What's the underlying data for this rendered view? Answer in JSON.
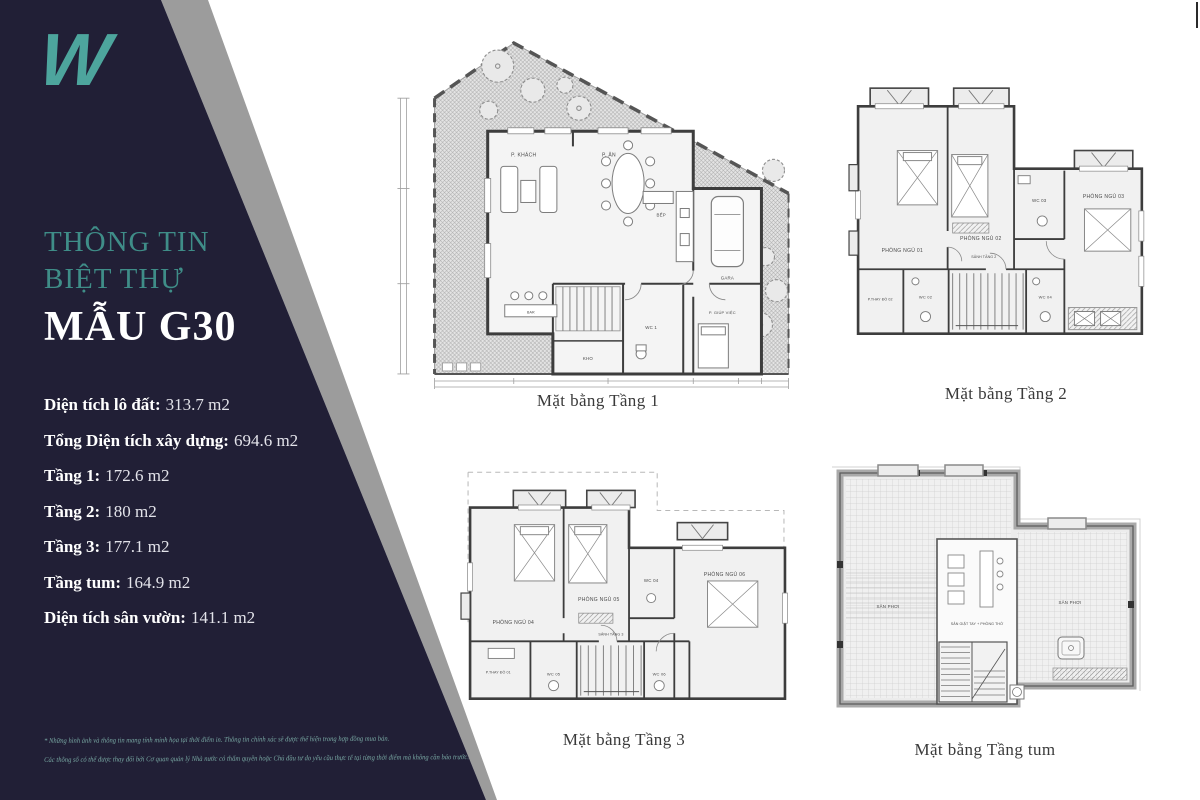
{
  "colors": {
    "navy": "#211f36",
    "gray_stripe": "#9c9c9c",
    "teal_logo": "#4da59d",
    "teal_heading": "#3f8d88",
    "disclaimer_teal": "#78a7a2",
    "caption_text": "#3a3a3a"
  },
  "sidebar": {
    "logo": "W",
    "title_line1": "THÔNG TIN",
    "title_line2": "BIỆT THỰ",
    "model": "MẪU G30",
    "stats": [
      {
        "label": "Diện tích lô đất:",
        "value": "313.7 m2"
      },
      {
        "label": "Tổng Diện tích xây dựng:",
        "value": "694.6 m2"
      },
      {
        "label": "Tầng 1:",
        "value": "172.6 m2"
      },
      {
        "label": "Tầng 2:",
        "value": "180 m2"
      },
      {
        "label": "Tầng 3:",
        "value": "177.1 m2"
      },
      {
        "label": "Tầng tum:",
        "value": "164.9 m2"
      },
      {
        "label": "Diện tích sân vườn:",
        "value": "141.1 m2"
      }
    ],
    "disclaimer_line1": "* Những hình ảnh và thông tin mang tính minh họa tại thời điểm in. Thông tin chính xác sẽ được thể hiện trong hợp đồng mua bán.",
    "disclaimer_line2": "Các thông số có thể được thay đổi bởi Cơ quan quản lý Nhà nước có thẩm quyền hoặc Chủ đầu tư do yêu cầu thực tế tại từng thời điểm mà không cần báo trước."
  },
  "plans": {
    "t1": {
      "caption": "Mặt bằng Tầng 1",
      "rooms": {
        "khach": "P. KHÁCH",
        "an": "P. ĂN",
        "bep": "BẾP",
        "gara": "GARA",
        "kho": "KHO",
        "wc1": "WC 1",
        "giupviec": "P. GIÚP VIỆC",
        "bar": "BAR"
      }
    },
    "t2": {
      "caption": "Mặt bằng Tầng 2",
      "rooms": {
        "ngu01": "PHÒNG NGỦ 01",
        "ngu02": "PHÒNG NGỦ 02",
        "ngu03": "PHÒNG NGỦ 03",
        "wc03": "WC 03",
        "sanh": "SẢNH TẦNG 2",
        "thaydo": "P.THAY ĐỒ 02",
        "wc02": "WC 02",
        "wc04": "WC 04"
      }
    },
    "t3": {
      "caption": "Mặt bằng Tầng 3",
      "rooms": {
        "ngu04": "PHÒNG NGỦ 04",
        "ngu05": "PHÒNG NGỦ 05",
        "ngu06": "PHÒNG NGỦ 06",
        "wc04": "WC 04",
        "sanh": "SẢNH TẦNG 3",
        "thaydo": "P.THAY ĐỒ 01",
        "wc05": "WC 05",
        "wc06": "WC 06"
      }
    },
    "tum": {
      "caption": "Mặt bằng Tầng tum",
      "rooms": {
        "san_phoi_trai": "SÂN PHƠI",
        "giat_tho": "SÂN GIẶT TAY + PHÒNG THỜ",
        "san_phoi_phai": "SÂN PHƠI"
      }
    }
  }
}
